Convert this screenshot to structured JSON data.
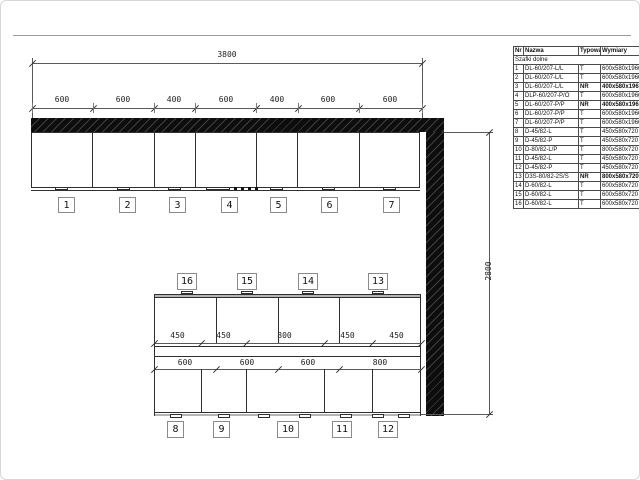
{
  "drawing": {
    "overall_width": "3800",
    "overall_height": "2800",
    "top_segments": [
      "600",
      "600",
      "400",
      "600",
      "400",
      "600",
      "600"
    ],
    "wall_cabinet_numbers": [
      "1",
      "2",
      "3",
      "4",
      "5",
      "6",
      "7"
    ],
    "island_top_numbers": [
      "16",
      "15",
      "14",
      "13"
    ],
    "island_bottom_numbers": [
      "8",
      "9",
      "10",
      "11",
      "12"
    ],
    "island_upper_dims": [
      "450",
      "450",
      "800",
      "450",
      "450"
    ],
    "island_lower_dims": [
      "600",
      "600",
      "600",
      "800"
    ]
  },
  "table": {
    "headers": [
      "Nr",
      "Nazwa",
      "Typowa",
      "Wymiary"
    ],
    "group_label": "Szafki dolne",
    "rows": [
      {
        "nr": "1",
        "nazwa": "DL-60/207-L/L",
        "typowa": "T",
        "wymiary": "600x580x1966",
        "bold": false
      },
      {
        "nr": "2",
        "nazwa": "DL-60/207-L/L",
        "typowa": "T",
        "wymiary": "600x580x1966",
        "bold": false
      },
      {
        "nr": "3",
        "nazwa": "DL-60/207-L/L",
        "typowa": "NR",
        "wymiary": "400x580x1966",
        "bold": true
      },
      {
        "nr": "4",
        "nazwa": "DLP-60/207-P/O",
        "typowa": "T",
        "wymiary": "600x580x1966",
        "bold": false
      },
      {
        "nr": "5",
        "nazwa": "DL-60/207-P/P",
        "typowa": "NR",
        "wymiary": "400x580x1966",
        "bold": true
      },
      {
        "nr": "6",
        "nazwa": "DL-60/207-P/P",
        "typowa": "T",
        "wymiary": "600x580x1966",
        "bold": false
      },
      {
        "nr": "7",
        "nazwa": "DL-60/207-P/P",
        "typowa": "T",
        "wymiary": "600x580x1966",
        "bold": false
      },
      {
        "nr": "8",
        "nazwa": "D-45/82-L",
        "typowa": "T",
        "wymiary": "450x580x720",
        "bold": false
      },
      {
        "nr": "9",
        "nazwa": "D-45/82-P",
        "typowa": "T",
        "wymiary": "450x580x720",
        "bold": false
      },
      {
        "nr": "10",
        "nazwa": "D-80/82-L/P",
        "typowa": "T",
        "wymiary": "800x580x720",
        "bold": false
      },
      {
        "nr": "11",
        "nazwa": "D-45/82-L",
        "typowa": "T",
        "wymiary": "450x580x720",
        "bold": false
      },
      {
        "nr": "12",
        "nazwa": "D-45/82-P",
        "typowa": "T",
        "wymiary": "450x580x720",
        "bold": false
      },
      {
        "nr": "13",
        "nazwa": "D3S-80/82-2S/S",
        "typowa": "NR",
        "wymiary": "800x580x720",
        "bold": true
      },
      {
        "nr": "14",
        "nazwa": "D-60/82-L",
        "typowa": "T",
        "wymiary": "600x580x720",
        "bold": false
      },
      {
        "nr": "15",
        "nazwa": "D-60/82-L",
        "typowa": "T",
        "wymiary": "600x580x720",
        "bold": false
      },
      {
        "nr": "16",
        "nazwa": "D-60/82-L",
        "typowa": "T",
        "wymiary": "600x580x720",
        "bold": false
      }
    ]
  }
}
